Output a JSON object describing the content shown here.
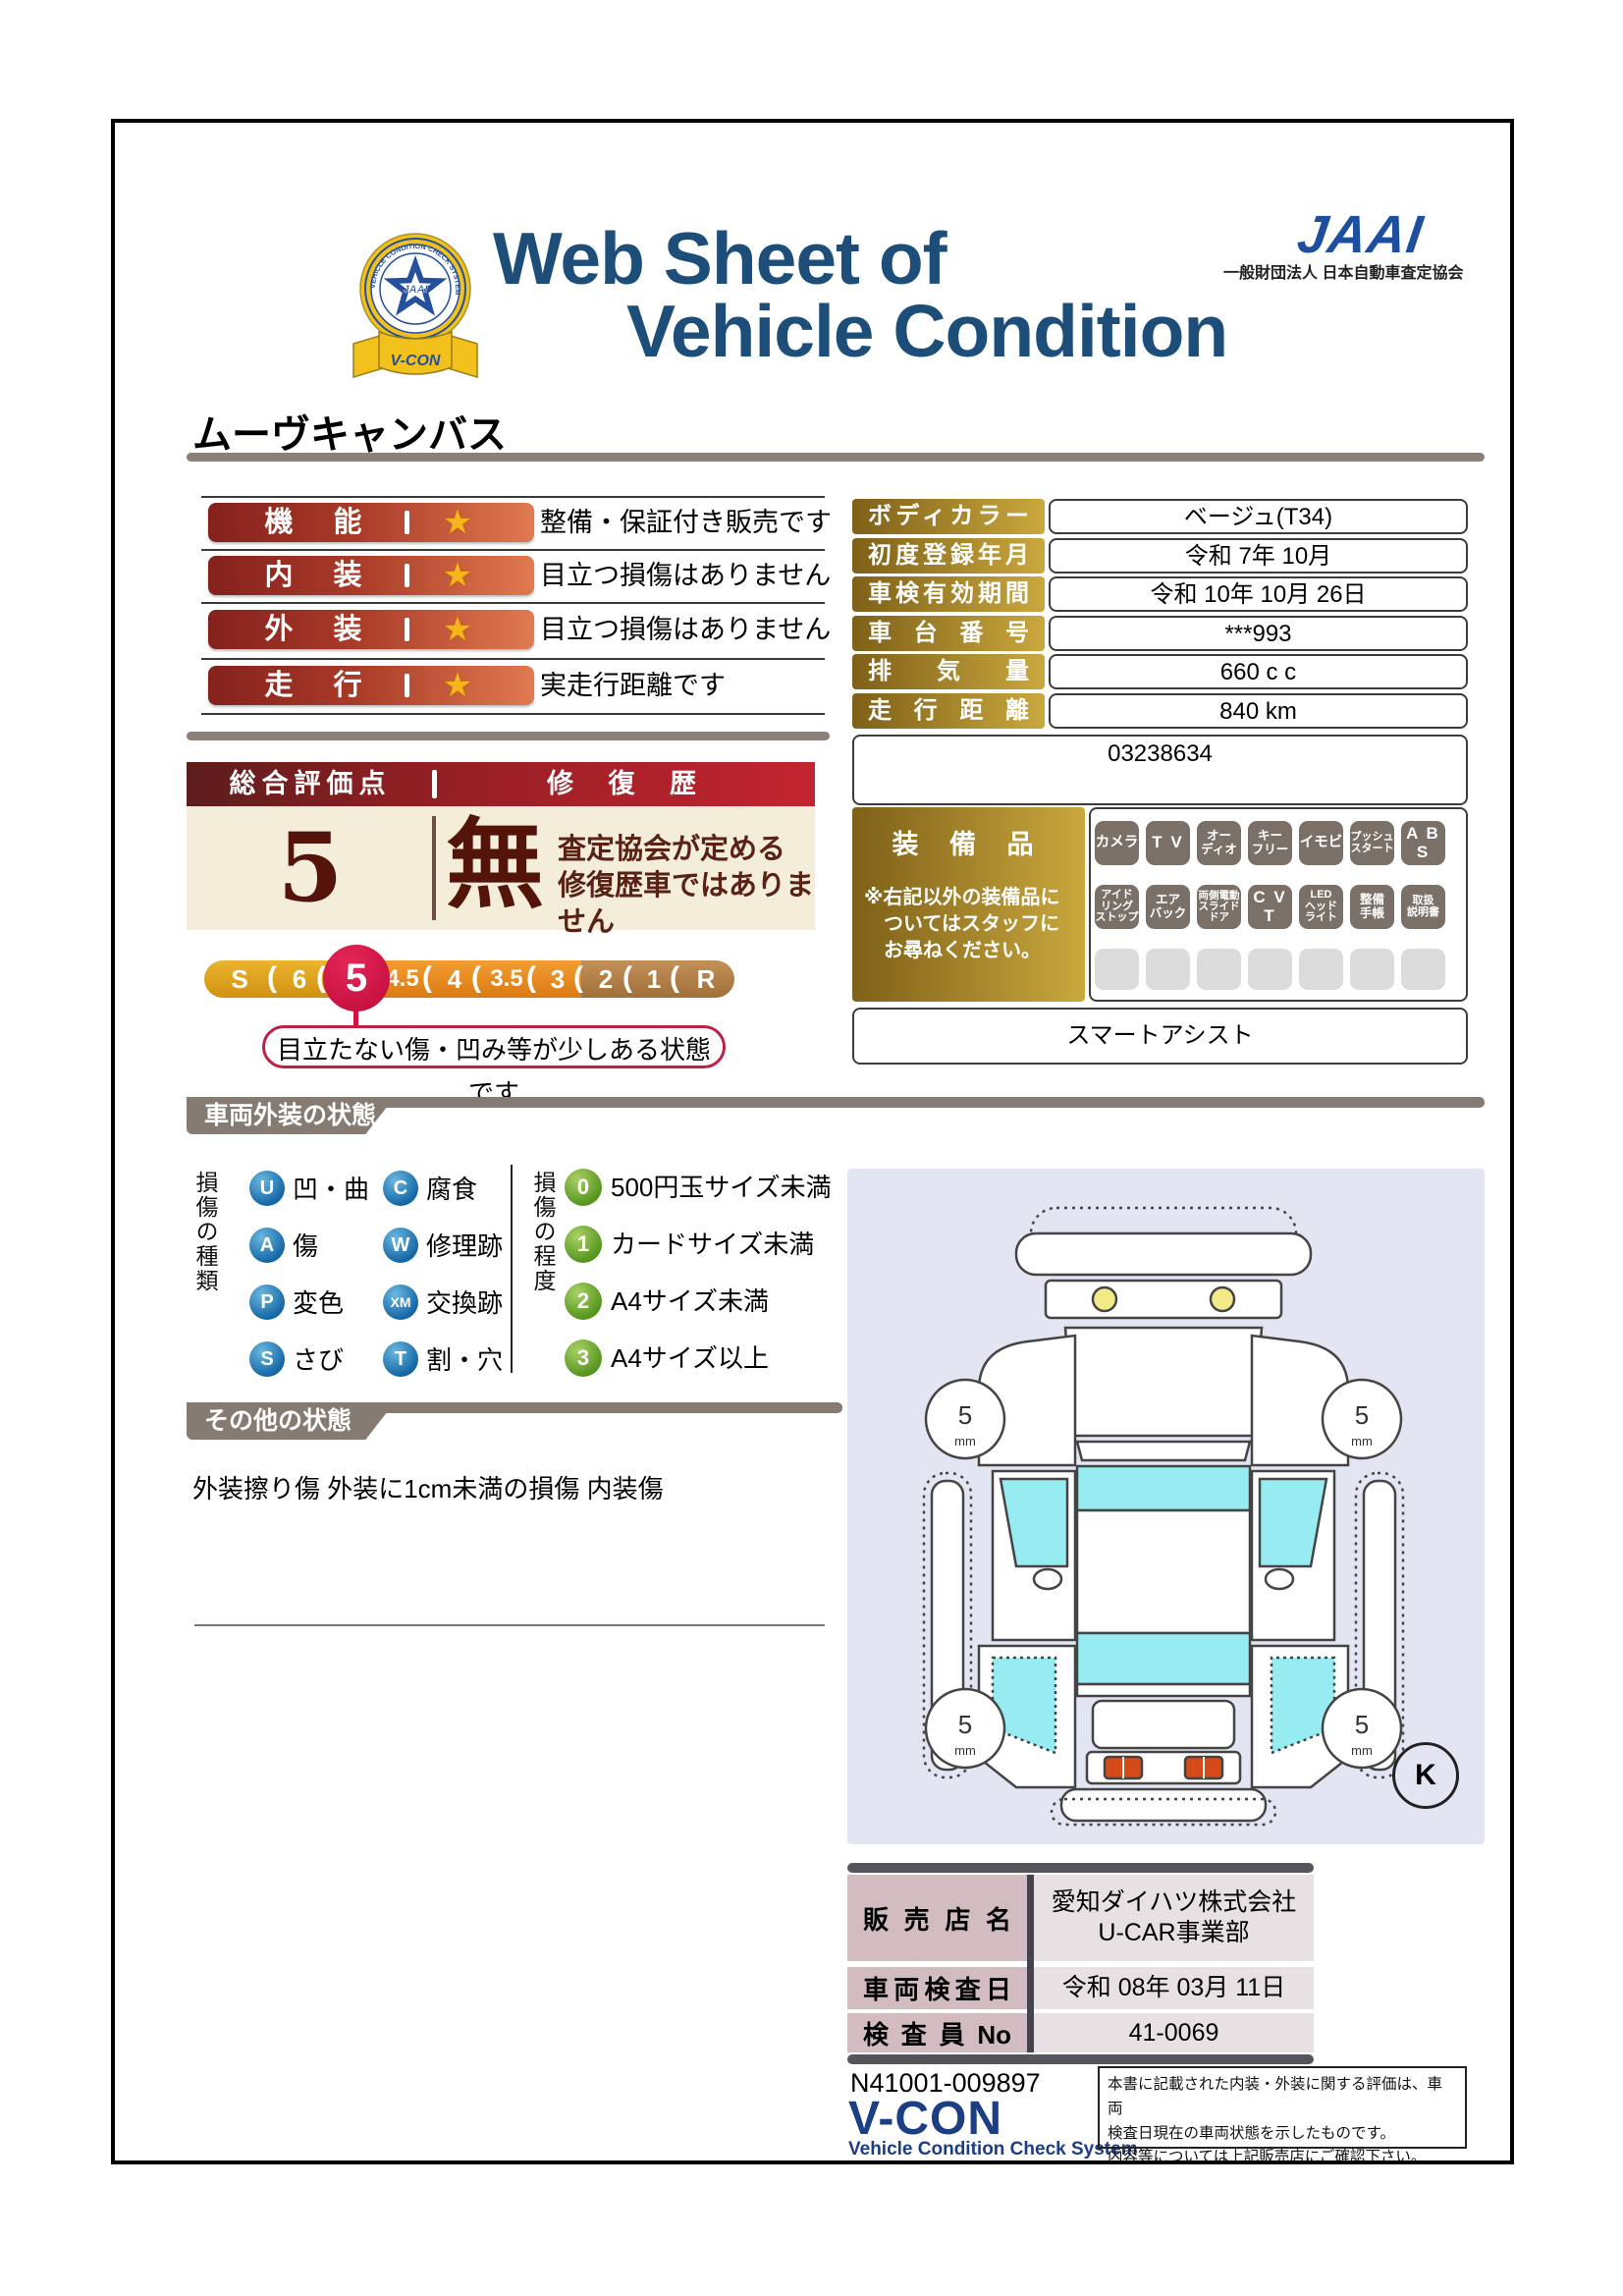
{
  "header": {
    "title_line1": "Web Sheet of",
    "title_line2": "Vehicle Condition",
    "jaai_logo": "JAAI",
    "jaai_tagline": "一般財団法人 日本自動車査定協会",
    "emblem": {
      "ring_text": "VEHICLE CONDITION CHECK SYSTEM",
      "center": "JAAI",
      "ribbon": "V-CON"
    }
  },
  "vehicle_name": "ムーヴキャンバス",
  "ratings": {
    "star_icon": "★",
    "rows": [
      {
        "label": "機　能",
        "comment": "整備・保証付き販売です"
      },
      {
        "label": "内　装",
        "comment": "目立つ損傷はありません"
      },
      {
        "label": "外　装",
        "comment": "目立つ損傷はありません"
      },
      {
        "label": "走　行",
        "comment": "実走行距離です"
      }
    ]
  },
  "overall": {
    "header_left": "総合評価点",
    "header_right": "修 復 歴",
    "score": "5",
    "repair_flag": "無",
    "repair_note": "査定協会が定める\n修復歴車ではありません",
    "separator_glyph": "(",
    "scale": [
      "S",
      "6",
      "5",
      "4.5",
      "4",
      "3.5",
      "3",
      "2",
      "1",
      "R"
    ],
    "selected_value": "5",
    "callout": "目立たない傷・凹み等が少しある状態です"
  },
  "info_table": {
    "rows": [
      {
        "label": "ボディカラー",
        "value": "ベージュ(T34)"
      },
      {
        "label": "初度登録年月",
        "value": "令和 7年 10月"
      },
      {
        "label": "車検有効期間",
        "value": "令和 10年 10月 26日"
      },
      {
        "label": "車台番号",
        "value": "***993"
      },
      {
        "label": "排気量",
        "value": "660 c c"
      },
      {
        "label": "走行距離",
        "value": "840 km"
      }
    ],
    "ref_number": "03238634"
  },
  "equipment": {
    "title": "装 備 品",
    "note": "※右記以外の装備品に\n　ついてはスタッフに\n　お尋ねください。",
    "row1": [
      "カメラ",
      "T V",
      "オー\nディオ",
      "キー\nフリー",
      "イモビ",
      "プッシュ\nスタート",
      "A B S"
    ],
    "row2": [
      "アイド\nリング\nストップ",
      "エア\nバック",
      "両側電動\nスライド\nドア",
      "C V T",
      "LED\nヘッド\nライト",
      "整備\n手帳",
      "取扱\n説明書"
    ],
    "extra": "スマートアシスト"
  },
  "exterior": {
    "banner": "車両外装の状態",
    "type_title": "損傷の種類",
    "types": [
      {
        "code": "U",
        "label": "凹・曲"
      },
      {
        "code": "C",
        "label": "腐食"
      },
      {
        "code": "A",
        "label": "傷"
      },
      {
        "code": "W",
        "label": "修理跡"
      },
      {
        "code": "P",
        "label": "変色"
      },
      {
        "code": "XM",
        "label": "交換跡"
      },
      {
        "code": "S",
        "label": "さび"
      },
      {
        "code": "T",
        "label": "割・穴"
      }
    ],
    "degree_title": "損傷の程度",
    "degrees": [
      {
        "code": "0",
        "label": "500円玉サイズ未満"
      },
      {
        "code": "1",
        "label": "カードサイズ未満"
      },
      {
        "code": "2",
        "label": "A4サイズ未満"
      },
      {
        "code": "3",
        "label": "A4サイズ以上"
      }
    ]
  },
  "other_status": {
    "banner": "その他の状態",
    "text": "外装擦り傷 外装に1cm未満の損傷 内装傷"
  },
  "diagram": {
    "tire_label": "5",
    "tire_unit": "mm",
    "marker": "K"
  },
  "dealer": {
    "rows": [
      {
        "label": "販売店名",
        "value": "愛知ダイハツ株式会社\nU-CAR事業部"
      },
      {
        "label": "車両検査日",
        "value": "令和 08年 03月 11日"
      },
      {
        "label": "検査員No",
        "value": "41-0069"
      }
    ]
  },
  "footer": {
    "doc_number": "N41001-009897",
    "vcon": "V-CON",
    "vcon_sub": "Vehicle Condition Check System",
    "note": "本書に記載された内装・外装に関する評価は、車両\n検査日現在の車両状態を示したものです。\n内容等については上記販売店にご確認下さい。"
  },
  "colors": {
    "title_navy": "#1d4d79",
    "jaai_blue": "#1e4f9e",
    "pill_red": "#84211c",
    "pill_orange": "#e07a50",
    "maroon": "#541409",
    "gold_dark": "#7e6018",
    "gold_light": "#caa83e",
    "badge_gray": "#7b7068",
    "scale_gold": "#d99f1b",
    "scale_orange": "#e8891d",
    "scale_brown": "#b08049",
    "selected_red": "#cf1340",
    "banner_gray": "#867b73",
    "damage_type_blue": "#1566a6",
    "damage_degree_green": "#55951f",
    "panel_lavender": "#e3e6f2",
    "window_cyan": "#97ecf1",
    "cream": "#f3edda"
  }
}
